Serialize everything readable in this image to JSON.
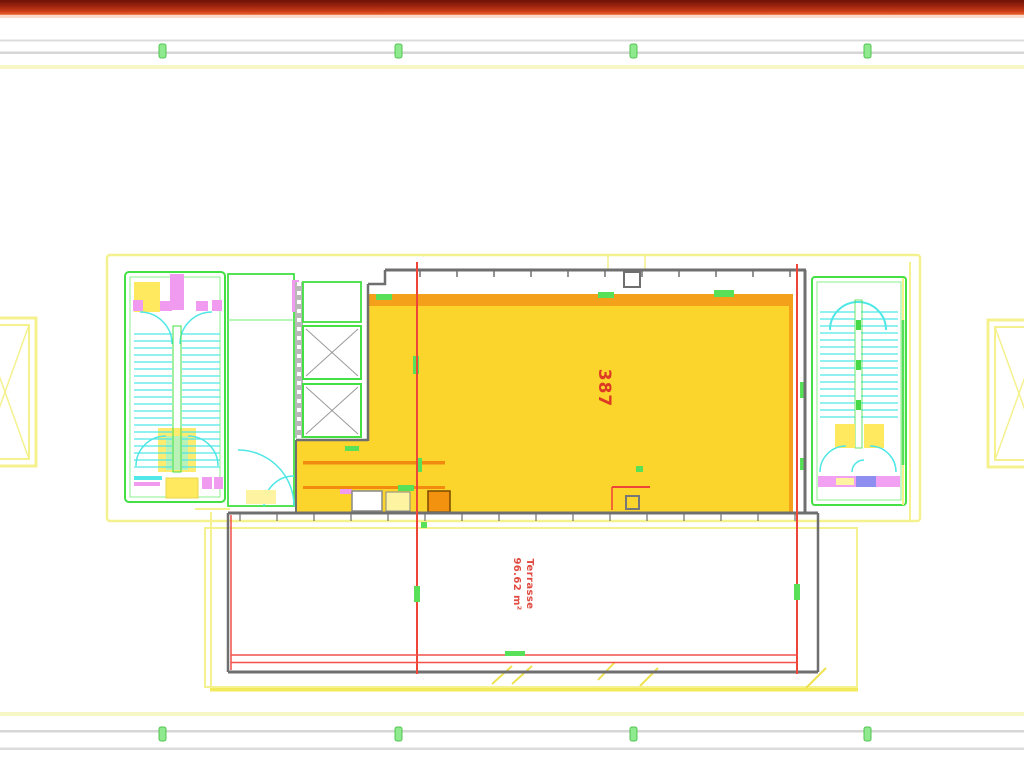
{
  "page": {
    "type": "cad-floor-plan-slide",
    "background": "#ffffff"
  },
  "header_bar": {
    "gradient_top": "#6e1206",
    "gradient_mid": "#c63a15",
    "gradient_bottom": "#f0926a"
  },
  "guide_rails": {
    "rail_color": "#d9d9d9",
    "accent_line_color": "#f7f7c6",
    "tick_color": "#8fe98f",
    "tick_positions_x": [
      159,
      395,
      630,
      864
    ]
  },
  "floor_plan": {
    "labels": {
      "hall_number": "387",
      "terrace_name": "Terrasse",
      "terrace_area": "96.62 m²"
    },
    "colors": {
      "hall_fill": "#fbd42c",
      "hall_band_orange": "#f4a01a",
      "label_red": "#dd3a26",
      "terrace_label_red": "#e04a40",
      "wall_gray": "#6f6f6f",
      "grid_line_red": "#ef4438",
      "outline_green": "#42e042",
      "tick_green": "#58e058",
      "stair_cyan": "#4fe6e6",
      "door_magenta": "#f09af0",
      "fixture_blue": "#8e8ef0",
      "boundary_yellow": "#f4f18e",
      "bright_yellow_line": "#f1ea5a",
      "pale_fill_yellow": "#ffe95e",
      "shaft_fill": "#fbe84e"
    }
  }
}
